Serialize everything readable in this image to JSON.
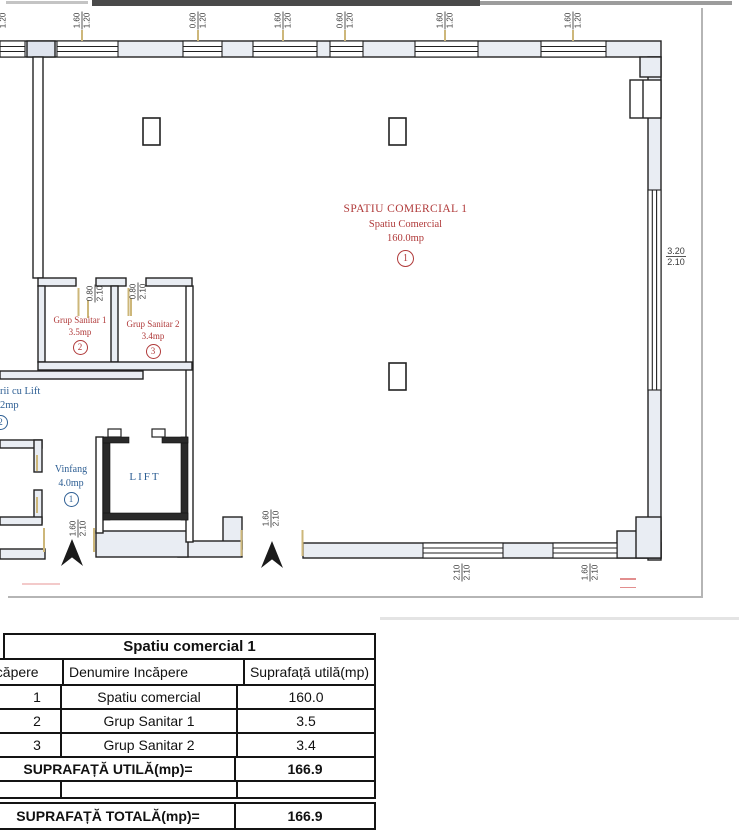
{
  "plan": {
    "main_room": {
      "title": "SPATIU COMERCIAL 1",
      "subtitle": "Spatiu Comercial",
      "area": "160.0mp",
      "index": "1"
    },
    "grup_sanitar_1": {
      "name": "Grup Sanitar 1",
      "area": "3.5mp",
      "index": "2"
    },
    "grup_sanitar_2": {
      "name": "Grup Sanitar 2",
      "area": "3.4mp",
      "index": "3"
    },
    "staircase": {
      "name_partial": "rii cu Lift",
      "area_partial": "2mp",
      "index": "2"
    },
    "vinfang": {
      "name": "Vinfang",
      "area": "4.0mp",
      "index": "1"
    },
    "lift": {
      "label": "LIFT"
    },
    "dims": {
      "d1": {
        "top": "1.60",
        "bot": "1.20"
      },
      "d2": {
        "top": "1.60",
        "bot": "1.20"
      },
      "d3": {
        "top": "0.60",
        "bot": "1.20"
      },
      "d4": {
        "top": "1.60",
        "bot": "1.20"
      },
      "d5": {
        "top": "0.60",
        "bot": "1.20"
      },
      "d6": {
        "top": "1.60",
        "bot": "1.20"
      },
      "d7": {
        "top": "1.60",
        "bot": "1.20"
      },
      "d8": {
        "top": "0.80",
        "bot": "2.10"
      },
      "d9": {
        "top": "0.80",
        "bot": "2.10"
      },
      "d10": {
        "top": "1.60",
        "bot": "2.10"
      },
      "d11": {
        "top": "1.60",
        "bot": "2.10"
      },
      "d12": {
        "top": "2.10",
        "bot": "2.10"
      },
      "d13": {
        "top": "1.60",
        "bot": "2.10"
      },
      "d14": {
        "top": "3.20",
        "bot": "2.10"
      }
    },
    "colors": {
      "room_label_red": "#b03a3a",
      "label_blue": "#2e5f94",
      "door_accent": "#cdb77a",
      "wall_line": "#222222",
      "wall_fill": "#e9edf3"
    }
  },
  "table": {
    "title": "Spatiu comercial 1",
    "headers": [
      "ncăpere",
      "Denumire Incăpere",
      "Suprafață utilă(mp)"
    ],
    "rows": [
      {
        "nr": "1",
        "name": "Spatiu comercial",
        "area": "160.0"
      },
      {
        "nr": "2",
        "name": "Grup Sanitar 1",
        "area": "3.5"
      },
      {
        "nr": "3",
        "name": "Grup Sanitar 2",
        "area": "3.4"
      }
    ],
    "total_util_label": "SUPRAFAȚĂ UTILĂ(mp)=",
    "total_util_value": "166.9",
    "total_label": "SUPRAFAȚĂ TOTALĂ(mp)=",
    "total_value": "166.9"
  }
}
